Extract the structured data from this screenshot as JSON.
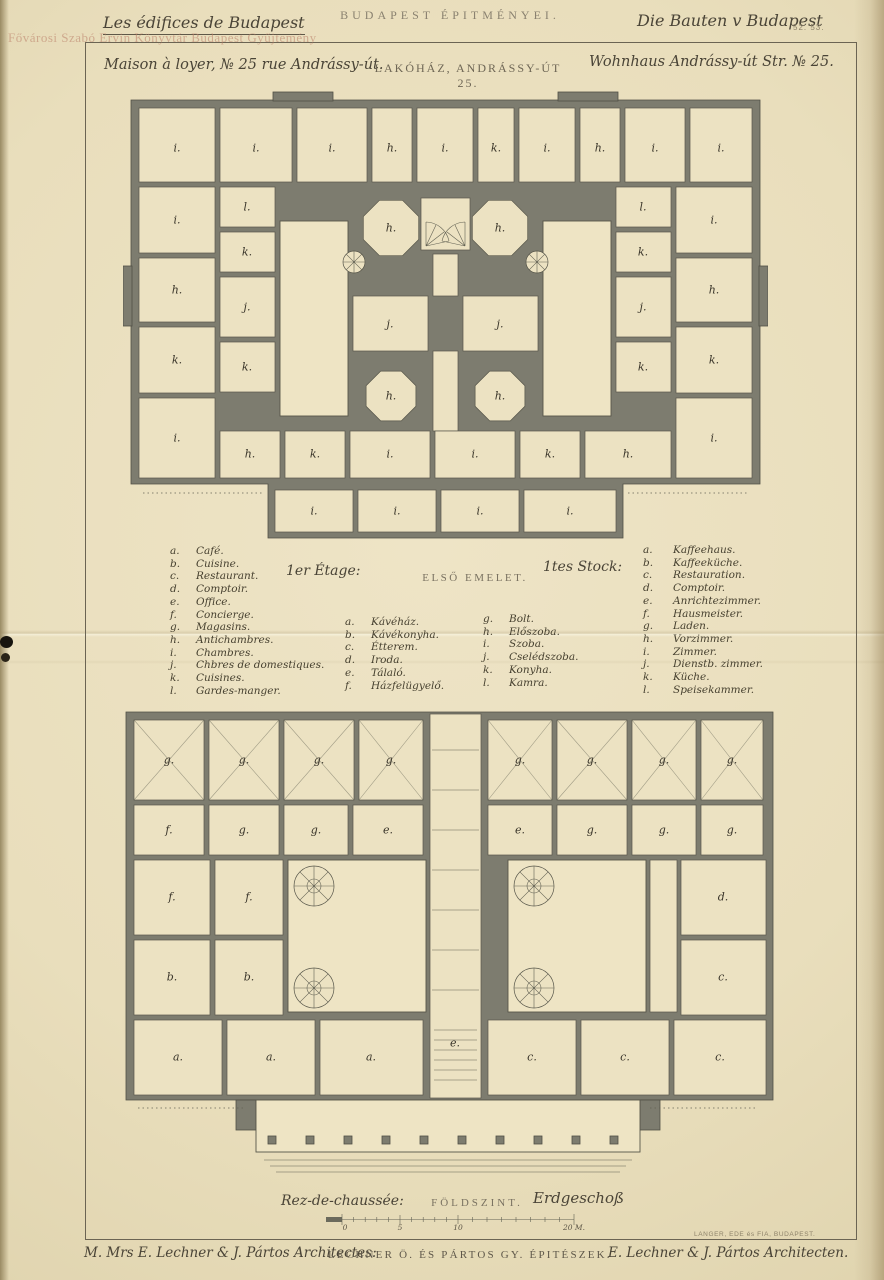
{
  "page": {
    "series_title_fr": "Les édifices de Budapest",
    "series_title_hu": "BUDAPEST ÉPITMÉNYEI.",
    "series_title_de": "Die Bauten v Budapest",
    "plate_number": "52. 53.",
    "watermark": "Fővárosi Szabó Ervin Könyvtár Budapest Gyűjtemény"
  },
  "subtitle": {
    "fr": "Maison à loyer, № 25 rue Andrássy-út.",
    "hu": "LAKÓHÁZ, ANDRÁSSY-ÚT 25.",
    "de": "Wohnhaus Andrássy-út Str. № 25."
  },
  "floors": {
    "first": {
      "fr": "1er Étage:",
      "hu": "ELSŐ EMELET.",
      "de": "1tes Stock:"
    },
    "ground": {
      "fr": "Rez-de-chaussée:",
      "hu": "FÖLDSZINT.",
      "de": "Erdgeschoß"
    }
  },
  "legend": {
    "french": [
      {
        "letter": "a",
        "label": "Café."
      },
      {
        "letter": "b",
        "label": "Cuisine."
      },
      {
        "letter": "c",
        "label": "Restaurant."
      },
      {
        "letter": "d",
        "label": "Comptoir."
      },
      {
        "letter": "e",
        "label": "Office."
      },
      {
        "letter": "f",
        "label": "Concierge."
      },
      {
        "letter": "g",
        "label": "Magasins."
      },
      {
        "letter": "h",
        "label": "Antichambres."
      },
      {
        "letter": "i",
        "label": "Chambres."
      },
      {
        "letter": "j",
        "label": "Chbres de domestiques."
      },
      {
        "letter": "k",
        "label": "Cuisines."
      },
      {
        "letter": "l",
        "label": "Gardes-manger."
      }
    ],
    "hungarian": [
      {
        "letter": "a",
        "label": "Kávéház."
      },
      {
        "letter": "b",
        "label": "Kávékonyha."
      },
      {
        "letter": "c",
        "label": "Étterem."
      },
      {
        "letter": "d",
        "label": "Iroda."
      },
      {
        "letter": "e",
        "label": "Tálaló."
      },
      {
        "letter": "f",
        "label": "Házfelügyelő."
      },
      {
        "letter": "g",
        "label": "Bolt."
      },
      {
        "letter": "h",
        "label": "Előszoba."
      },
      {
        "letter": "i",
        "label": "Szoba."
      },
      {
        "letter": "j",
        "label": "Cselédszoba."
      },
      {
        "letter": "k",
        "label": "Konyha."
      },
      {
        "letter": "l",
        "label": "Kamra."
      }
    ],
    "german": [
      {
        "letter": "a",
        "label": "Kaffeehaus."
      },
      {
        "letter": "b",
        "label": "Kaffeeküche."
      },
      {
        "letter": "c",
        "label": "Restauration."
      },
      {
        "letter": "d",
        "label": "Comptoir."
      },
      {
        "letter": "e",
        "label": "Anrichtezimmer."
      },
      {
        "letter": "f",
        "label": "Hausmeister."
      },
      {
        "letter": "g",
        "label": "Laden."
      },
      {
        "letter": "h",
        "label": "Vorzimmer."
      },
      {
        "letter": "i",
        "label": "Zimmer."
      },
      {
        "letter": "j",
        "label": "Dienstb. zimmer."
      },
      {
        "letter": "k",
        "label": "Küche."
      },
      {
        "letter": "l",
        "label": "Speisekammer."
      }
    ]
  },
  "scale_bar": {
    "ticks": [
      "0",
      "5",
      "10",
      "20 M."
    ]
  },
  "credits": {
    "fr": "M. Mrs E. Lechner & J. Pártos Architectes:",
    "hu": "LECHNER Ö. ÉS PÁRTOS GY. ÉPITÉSZEK.",
    "de": "E. Lechner & J. Pártos Architecten.",
    "printer": "LANGER, EDE és FIA, BUDAPEST."
  },
  "colors": {
    "paper": "#e9debc",
    "ink": "#4a4437",
    "wall_poche": "#7d7c6f",
    "watermark": "#ba7d67"
  },
  "plans": {
    "first_floor": {
      "name": "Első emelet / 1er Étage / 1tes Stock",
      "labels": [
        {
          "t": "i",
          "x": 54,
          "y": 62
        },
        {
          "t": "i",
          "x": 133,
          "y": 62
        },
        {
          "t": "i",
          "x": 209,
          "y": 62
        },
        {
          "t": "h",
          "x": 269,
          "y": 62
        },
        {
          "t": "i",
          "x": 322,
          "y": 62
        },
        {
          "t": "k",
          "x": 373,
          "y": 62
        },
        {
          "t": "i",
          "x": 424,
          "y": 62
        },
        {
          "t": "h",
          "x": 477,
          "y": 62
        },
        {
          "t": "i",
          "x": 532,
          "y": 62
        },
        {
          "t": "i",
          "x": 598,
          "y": 62
        },
        {
          "t": "i",
          "x": 54,
          "y": 134
        },
        {
          "t": "h",
          "x": 54,
          "y": 204
        },
        {
          "t": "k",
          "x": 54,
          "y": 274
        },
        {
          "t": "i",
          "x": 54,
          "y": 352
        },
        {
          "t": "i",
          "x": 591,
          "y": 134
        },
        {
          "t": "h",
          "x": 591,
          "y": 204
        },
        {
          "t": "k",
          "x": 591,
          "y": 274
        },
        {
          "t": "i",
          "x": 591,
          "y": 352
        },
        {
          "t": "l",
          "x": 124,
          "y": 121
        },
        {
          "t": "k",
          "x": 124,
          "y": 166
        },
        {
          "t": "j",
          "x": 124,
          "y": 221
        },
        {
          "t": "k",
          "x": 124,
          "y": 281
        },
        {
          "t": "l",
          "x": 520,
          "y": 121
        },
        {
          "t": "k",
          "x": 520,
          "y": 166
        },
        {
          "t": "j",
          "x": 520,
          "y": 221
        },
        {
          "t": "k",
          "x": 520,
          "y": 281
        },
        {
          "t": "h",
          "x": 268,
          "y": 142
        },
        {
          "t": "h",
          "x": 377,
          "y": 142
        },
        {
          "t": "j",
          "x": 267,
          "y": 238
        },
        {
          "t": "j",
          "x": 377,
          "y": 238
        },
        {
          "t": "h",
          "x": 268,
          "y": 310
        },
        {
          "t": "h",
          "x": 377,
          "y": 310
        },
        {
          "t": "h",
          "x": 127,
          "y": 368
        },
        {
          "t": "k",
          "x": 192,
          "y": 368
        },
        {
          "t": "i",
          "x": 267,
          "y": 368
        },
        {
          "t": "i",
          "x": 352,
          "y": 368
        },
        {
          "t": "k",
          "x": 427,
          "y": 368
        },
        {
          "t": "h",
          "x": 505,
          "y": 368
        },
        {
          "t": "i",
          "x": 191,
          "y": 425
        },
        {
          "t": "i",
          "x": 274,
          "y": 425
        },
        {
          "t": "i",
          "x": 357,
          "y": 425
        },
        {
          "t": "i",
          "x": 447,
          "y": 425
        }
      ]
    },
    "ground_floor": {
      "name": "Földszint / Rez-de-chaussée / Erdgeschoß",
      "labels": [
        {
          "t": "g",
          "x": 51,
          "y": 60
        },
        {
          "t": "g",
          "x": 126,
          "y": 60
        },
        {
          "t": "g",
          "x": 201,
          "y": 60
        },
        {
          "t": "g",
          "x": 273,
          "y": 60
        },
        {
          "t": "g",
          "x": 402,
          "y": 60
        },
        {
          "t": "g",
          "x": 474,
          "y": 60
        },
        {
          "t": "g",
          "x": 546,
          "y": 60
        },
        {
          "t": "g",
          "x": 614,
          "y": 60
        },
        {
          "t": "f",
          "x": 51,
          "y": 130
        },
        {
          "t": "g",
          "x": 126,
          "y": 130
        },
        {
          "t": "g",
          "x": 198,
          "y": 130
        },
        {
          "t": "e",
          "x": 270,
          "y": 130
        },
        {
          "t": "e",
          "x": 402,
          "y": 130
        },
        {
          "t": "g",
          "x": 474,
          "y": 130
        },
        {
          "t": "g",
          "x": 546,
          "y": 130
        },
        {
          "t": "g",
          "x": 614,
          "y": 130
        },
        {
          "t": "f",
          "x": 54,
          "y": 197
        },
        {
          "t": "b",
          "x": 54,
          "y": 277
        },
        {
          "t": "f",
          "x": 131,
          "y": 197
        },
        {
          "t": "b",
          "x": 131,
          "y": 277
        },
        {
          "t": "d",
          "x": 605,
          "y": 197
        },
        {
          "t": "c",
          "x": 605,
          "y": 277
        },
        {
          "t": "a",
          "x": 60,
          "y": 357
        },
        {
          "t": "a",
          "x": 153,
          "y": 357
        },
        {
          "t": "a",
          "x": 253,
          "y": 357
        },
        {
          "t": "e",
          "x": 337,
          "y": 343
        },
        {
          "t": "c",
          "x": 414,
          "y": 357
        },
        {
          "t": "c",
          "x": 507,
          "y": 357
        },
        {
          "t": "c",
          "x": 602,
          "y": 357
        }
      ]
    }
  }
}
